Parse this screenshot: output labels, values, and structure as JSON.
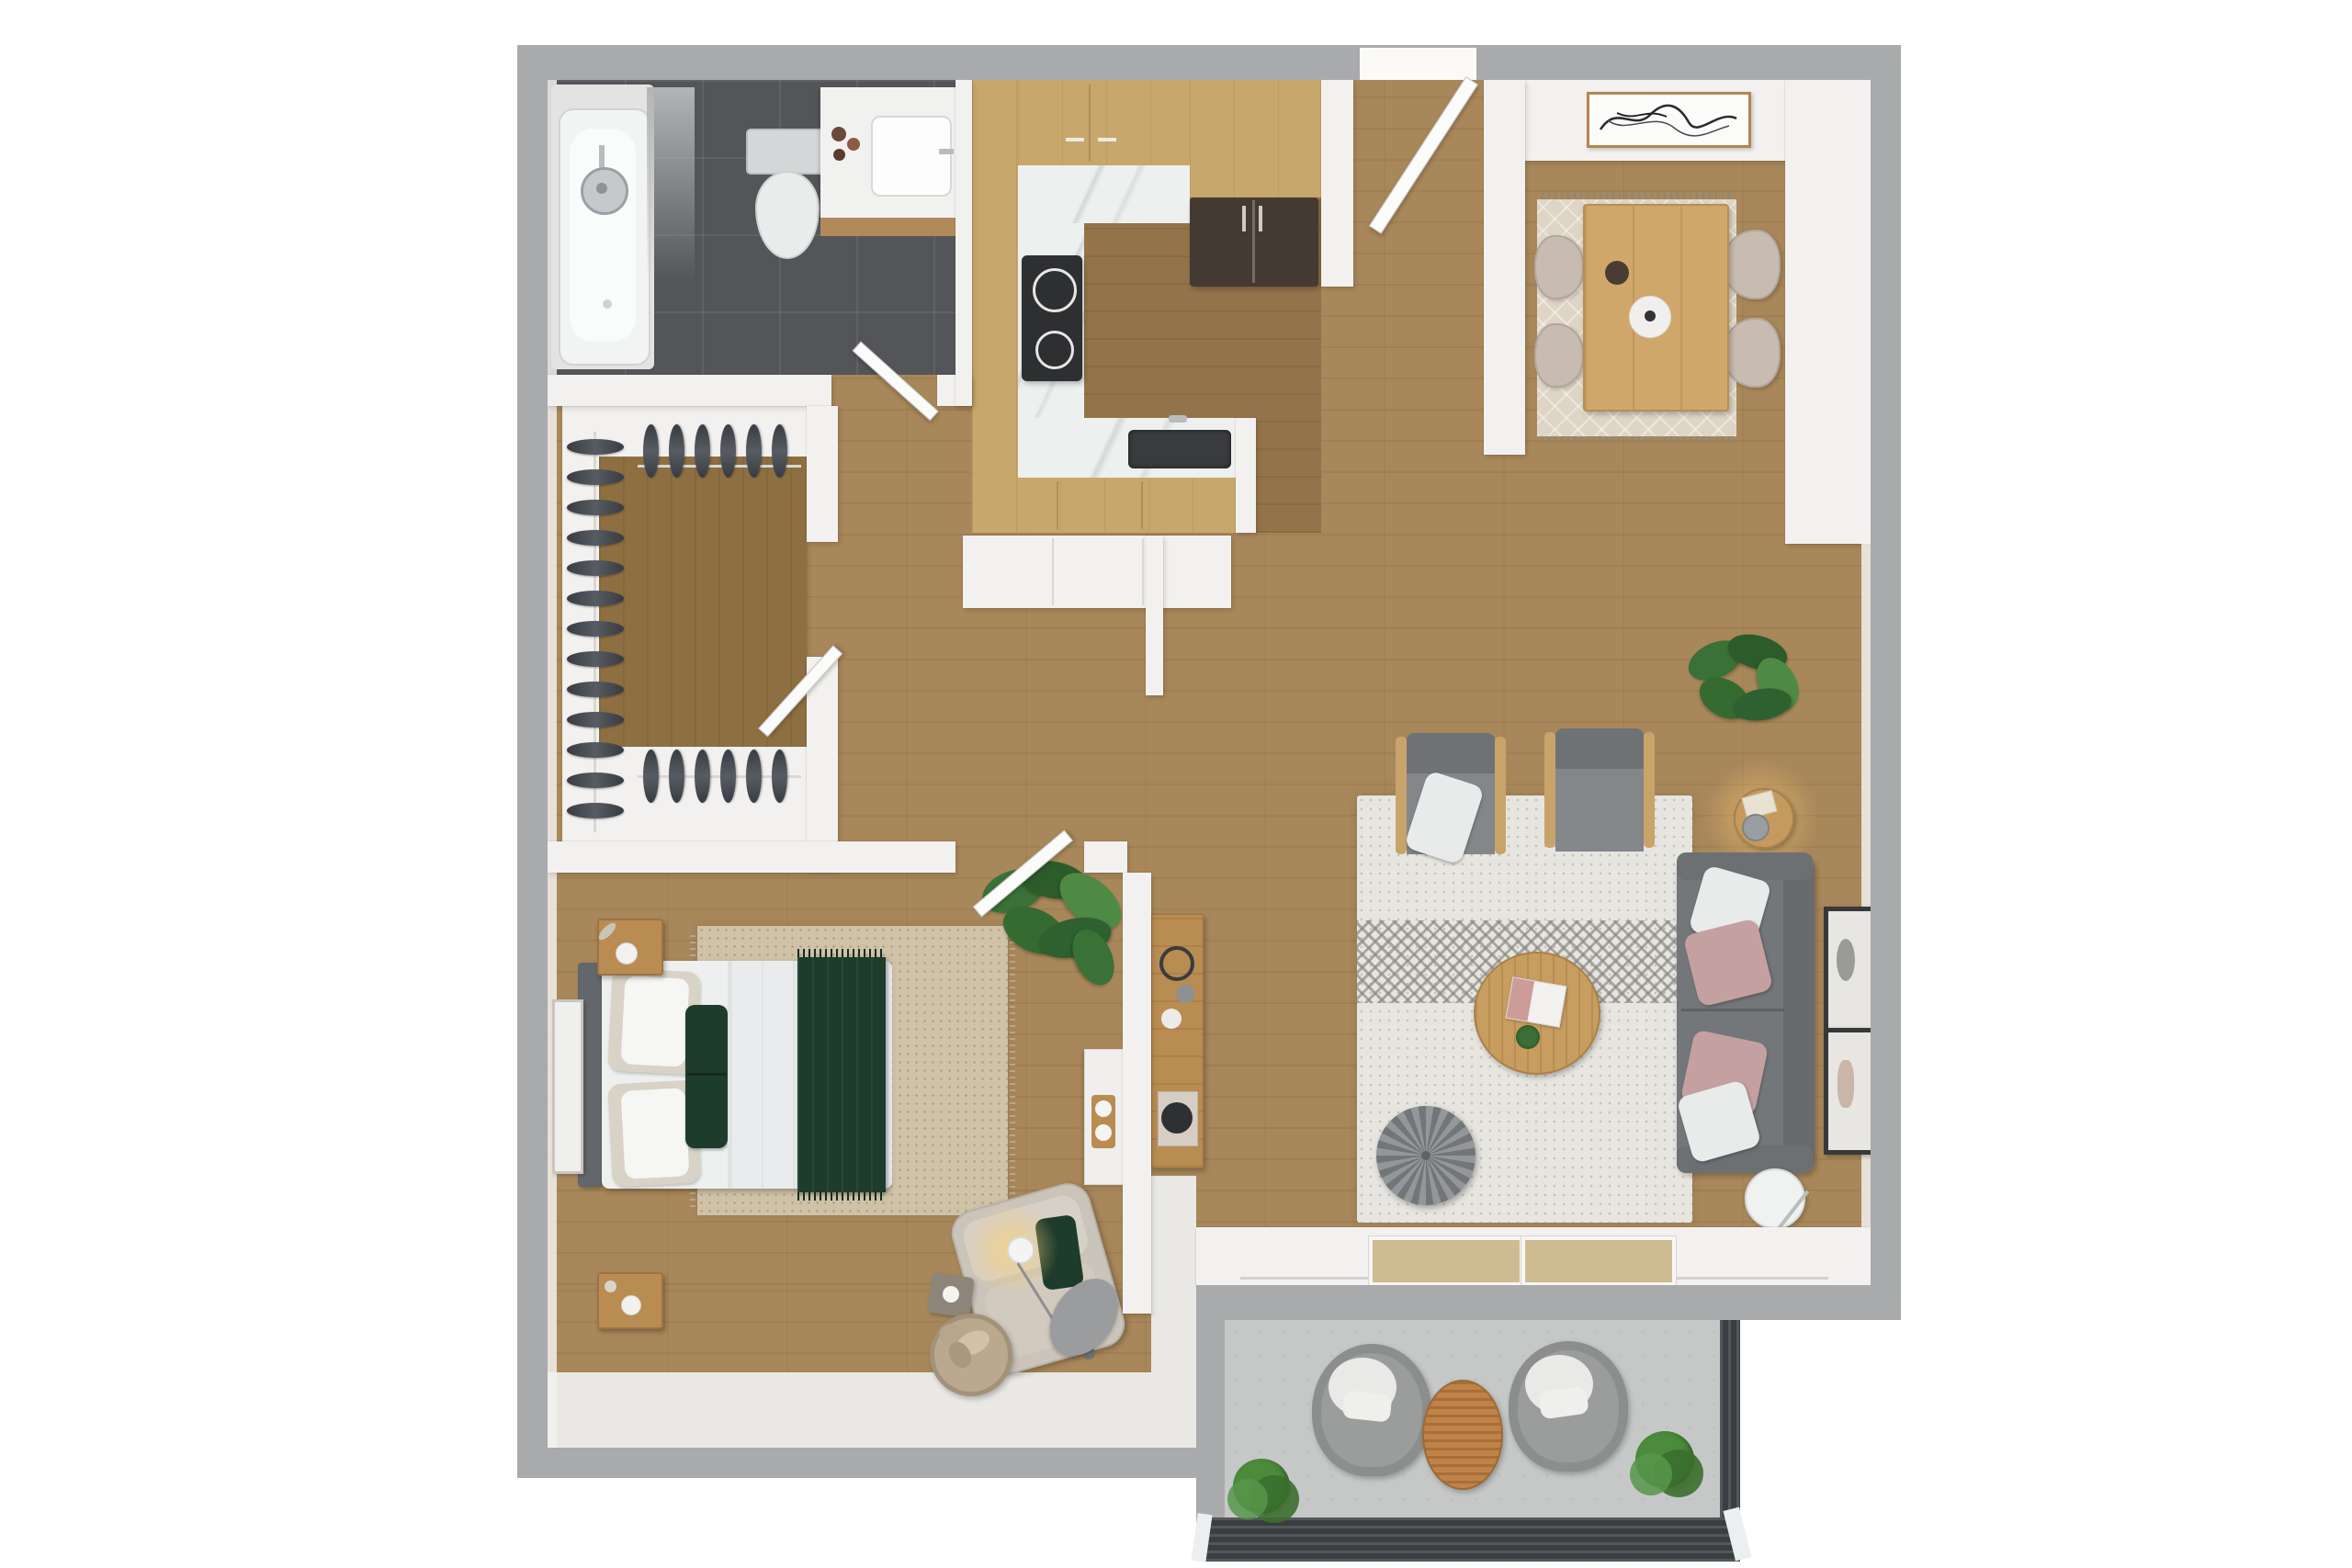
{
  "scene": {
    "kind": "3d-floor-plan-rendering",
    "view": "top-down",
    "visible_text": "none",
    "apartment_type": "one-bedroom-one-bath-with-balcony"
  },
  "palette": {
    "bg": "#ffffff",
    "outer_wall": "#a9aaac",
    "inner_wall": "#f2f1ef",
    "wood_main": "#a8875a",
    "wood_kitchen": "#93744a",
    "wood_closet": "#8d6f42",
    "wood_counter": "#c8a76c",
    "marble": "#eef0ef",
    "bath_floor": "#545559",
    "balcony_floor": "#c6c8c7",
    "railing": "#3b3e40",
    "rug_living": "#e7e5df",
    "rug_dining": "#ded5c6",
    "rug_bed": "#cfc2a6",
    "sofa": "#74777a",
    "sofa_dark": "#686b6e",
    "pillow_white": "#e9eaea",
    "pillow_pink": "#c5a0a0",
    "chair_gray": "#83878a",
    "chair_beige": "#c8bcb2",
    "pouf": "#828689",
    "table_wood": "#c79d60",
    "console_wood": "#b98c52",
    "dining_table": "#cfa76b",
    "green_dark": "#1e3c2b",
    "plant_green": "#3a7136",
    "fridge": "#453a32",
    "stove": "#2e2f31",
    "sink_dark": "#3a3b3d",
    "glass": "#cdbb92",
    "frame_dark": "#38383a",
    "bed_white": "#eef0f0",
    "duvet": "#e9ebec",
    "headboard": "#63666a",
    "pillow_beige": "#d9d2c6",
    "clothes_dark": "#4b4f55",
    "lamp_glow": "#f2c878",
    "patio_chair": "#9a9d9b",
    "patio_cushion": "#e9e9e7",
    "patio_table": "#c08347",
    "basket": "#baa98e",
    "mirror": "#e8e6e3"
  },
  "rooms": [
    {
      "name": "bathroom",
      "floor": "dark-gray-tile",
      "furniture": [
        "bathtub",
        "shower-head",
        "shower-curtain",
        "toilet",
        "vanity-with-sink"
      ]
    },
    {
      "name": "walk-in-closet",
      "floor": "wood",
      "furniture": [
        "hanging-clothes-left-rail",
        "hanging-clothes-top-rail",
        "hanging-clothes-bottom-rail"
      ]
    },
    {
      "name": "kitchen",
      "floor": "wood",
      "furniture": [
        "u-shaped-counter",
        "upper-cabinets",
        "stove-cooktop",
        "refrigerator",
        "sink",
        "storage-closet-below"
      ]
    },
    {
      "name": "dining-nook",
      "floor": "wood",
      "furniture": [
        "dining-table",
        "dining-chairs",
        "area-rug",
        "abstract-wall-art"
      ]
    },
    {
      "name": "living-room",
      "floor": "wood",
      "furniture": [
        "sofa",
        "accent-chair-with-throw",
        "accent-chair",
        "round-coffee-table",
        "pouf",
        "area-rug",
        "side-table-with-lamp",
        "floor-lamp",
        "tv-console",
        "wall-frames",
        "potted-plant"
      ]
    },
    {
      "name": "bedroom",
      "floor": "wood",
      "furniture": [
        "double-bed",
        "headboard",
        "nightstand-top",
        "nightstand-bottom",
        "area-rug",
        "leaning-mirror",
        "reading-chair",
        "arc-floor-lamp",
        "blanket-basket",
        "side-stool",
        "potted-tree",
        "wall-desk-shelf"
      ]
    },
    {
      "name": "balcony",
      "floor": "concrete",
      "furniture": [
        "patio-chair-left",
        "patio-chair-right",
        "patio-table",
        "planter-left",
        "planter-right",
        "railing"
      ]
    }
  ],
  "counts": {
    "dining_chairs": 4,
    "sofa_pillows": 4,
    "bed_pillows": 3,
    "closet_items_left_rail": 13,
    "closet_items_top_rail": 6,
    "closet_items_bottom_rail": 6,
    "wall_frames_living": 2,
    "balcony_chairs": 2,
    "balcony_planters": 2,
    "glass_door_panels": 2
  }
}
